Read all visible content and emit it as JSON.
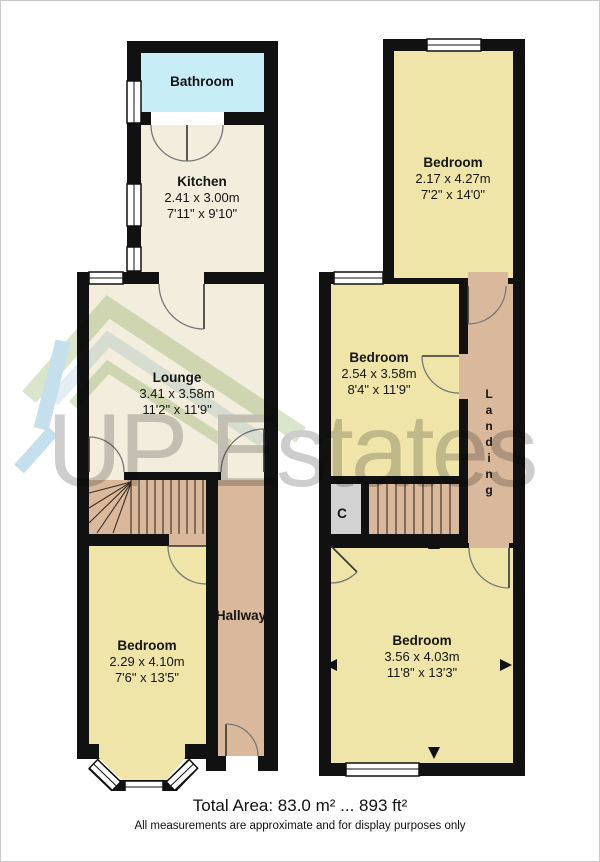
{
  "brand": {
    "watermark_text": "UP Estates"
  },
  "ground_floor": {
    "bathroom": {
      "name": "Bathroom"
    },
    "kitchen": {
      "name": "Kitchen",
      "metric": "2.41 x 3.00m",
      "imperial": "7'11\" x 9'10\""
    },
    "lounge": {
      "name": "Lounge",
      "metric": "3.41 x 3.58m",
      "imperial": "11'2\" x 11'9\""
    },
    "hallway": {
      "name": "Hallway"
    },
    "bedroom_front": {
      "name": "Bedroom",
      "metric": "2.29 x 4.10m",
      "imperial": "7'6\" x 13'5\""
    }
  },
  "first_floor": {
    "bedroom_front": {
      "name": "Bedroom",
      "metric": "2.17 x 4.27m",
      "imperial": "7'2\" x 14'0\""
    },
    "bedroom_middle": {
      "name": "Bedroom",
      "metric": "2.54 x 3.58m",
      "imperial": "8'4\" x 11'9\""
    },
    "landing": {
      "name": "Landing"
    },
    "cupboard": {
      "name": "C"
    },
    "bedroom_back": {
      "name": "Bedroom",
      "metric": "3.56 x 4.03m",
      "imperial": "11'8\" x 13'3\""
    }
  },
  "footer": {
    "total_area": "Total Area: 83.0 m² ... 893 ft²",
    "disclaimer": "All measurements are approximate and for display purposes only"
  },
  "colors": {
    "wall": "#111111",
    "bathroom_fill": "#c7edf6",
    "living_fill": "#f2eddc",
    "bedroom_fill": "#efe5a9",
    "circulation_fill": "#d9b89b",
    "cupboard_fill": "#d2d2d2",
    "watermark_gray": "#cdcdcd",
    "watermark_green": "#d9e6cc",
    "watermark_blue": "#c6dfec"
  }
}
